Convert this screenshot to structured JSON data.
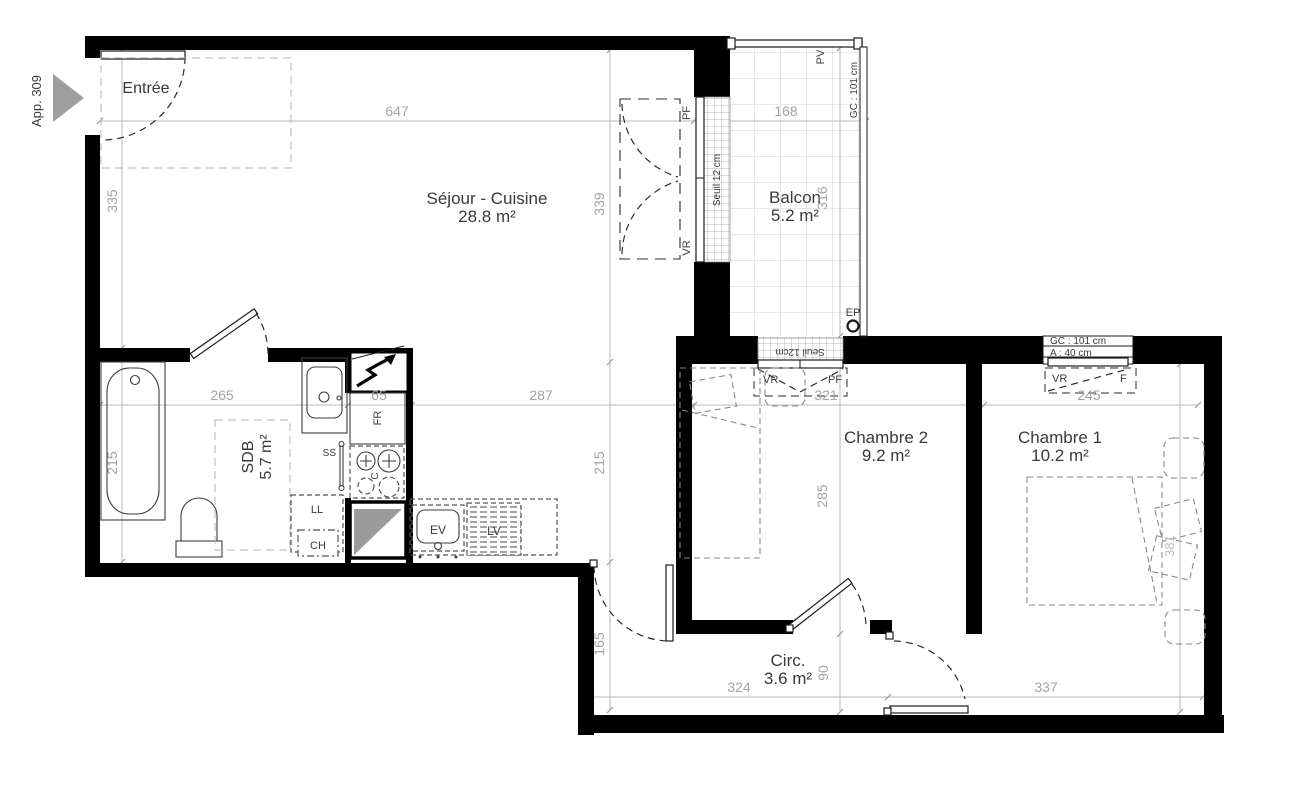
{
  "plan": {
    "app_label": "App. 309",
    "rooms": {
      "entree": {
        "name": "Entrée"
      },
      "sejour": {
        "name": "Séjour - Cuisine",
        "area": "28.8 m²"
      },
      "balcon": {
        "name": "Balcon",
        "area": "5.2 m²"
      },
      "sdb": {
        "name": "SDB",
        "area": "5.7 m²"
      },
      "chambre2": {
        "name": "Chambre 2",
        "area": "9.2 m²"
      },
      "chambre1": {
        "name": "Chambre 1",
        "area": "10.2 m²"
      },
      "circ": {
        "name": "Circ.",
        "area": "3.6 m²"
      }
    },
    "dimensions_cm": {
      "sejour_top_width": "647",
      "balcon_width": "168",
      "entree_height": "335",
      "sdb_height": "215",
      "sejour_height": "339",
      "sejour_lower_height": "215",
      "circ_height": "165",
      "balcon_height": "316",
      "chambre2_height": "285",
      "chambre2_door": "90",
      "sdb_width": "265",
      "kitchen_width": "65",
      "sejour_lower_width": "287",
      "chambre2_width": "321",
      "chambre1_width": "245",
      "circ_width": "324",
      "chambre1_lower_width": "337",
      "chambre1_height": "381"
    },
    "annotations": {
      "pv": "PV",
      "gc_balcon": "GC : 101 cm",
      "ep": "EP",
      "seuil_sejour": "Seuil 12 cm",
      "pf_sejour": "PF",
      "vr_sejour": "VR",
      "seuil_chambre2": "Seuil 12cm",
      "vr_chambre2": "VR",
      "pf_chambre2": "PF",
      "gc_chambre1": "GC : 101 cm",
      "allege_chambre1": "A : 40 cm",
      "vr_chambre1": "VR",
      "f_chambre1": "F",
      "fridge": "FR",
      "towel_dryer": "SS",
      "cooktop": "C",
      "washer": "LL",
      "water_heater": "CH",
      "sink": "EV",
      "dishwasher": "LV"
    }
  }
}
